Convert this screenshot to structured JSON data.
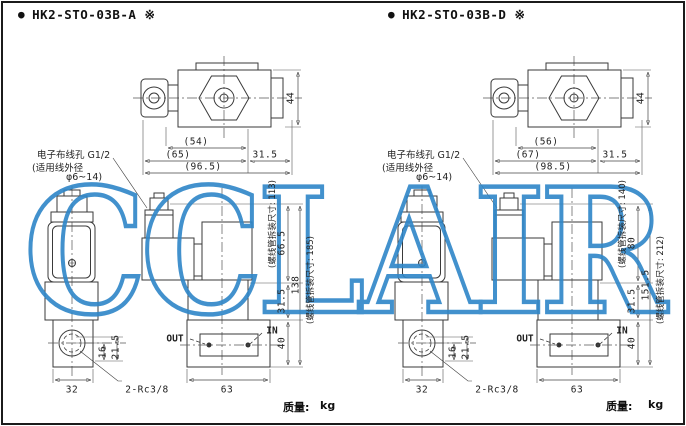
{
  "page": {
    "watermark_text": "CCLAIR",
    "watermark_color": "#2e86c8"
  },
  "figures": [
    {
      "bullet": "●",
      "title": "HK2-STO-03B-A ※",
      "notes": {
        "conduit_line1": "电子布线孔 G1/2",
        "conduit_line2": "(适用线外径",
        "conduit_line3": "φ6~14)",
        "solenoid_removal_upper": "(螺线管拆装尺寸: 113)",
        "solenoid_removal_lower": "(螺线管拆装尺寸: 185)"
      },
      "ports": {
        "out": "OUT",
        "in": "IN",
        "thread": "2-Rc3/8"
      },
      "dims": {
        "top_height": "44",
        "top_row1": "(54)",
        "top_row2a": "(65)",
        "top_row2b": "31.5",
        "top_row3": "(96.5)",
        "coil_height": "66.5",
        "body_height": "31.5",
        "base_height": "40",
        "total_height": "138",
        "front_width": "32",
        "base_width": "63",
        "port_offset1": "16",
        "port_offset2": "21.5"
      },
      "weight": {
        "label": "质量:",
        "unit": "kg"
      }
    },
    {
      "bullet": "●",
      "title": "HK2-STO-03B-D ※",
      "notes": {
        "conduit_line1": "电子布线孔 G1/2",
        "conduit_line2": "(适用线外径",
        "conduit_line3": "φ6~14)",
        "solenoid_removal_upper": "(螺线管拆装尺寸: 140)",
        "solenoid_removal_lower": "(螺线管拆装尺寸: 212)"
      },
      "ports": {
        "out": "OUT",
        "in": "IN",
        "thread": "2-Rc3/8"
      },
      "dims": {
        "top_height": "44",
        "top_row1": "(56)",
        "top_row2a": "(67)",
        "top_row2b": "31.5",
        "top_row3": "(98.5)",
        "coil_height": "80",
        "body_height": "31.5",
        "base_height": "40",
        "total_height": "151.5",
        "front_width": "32",
        "base_width": "63",
        "port_offset1": "16",
        "port_offset2": "21.5"
      },
      "weight": {
        "label": "质量:",
        "unit": "kg"
      }
    }
  ]
}
